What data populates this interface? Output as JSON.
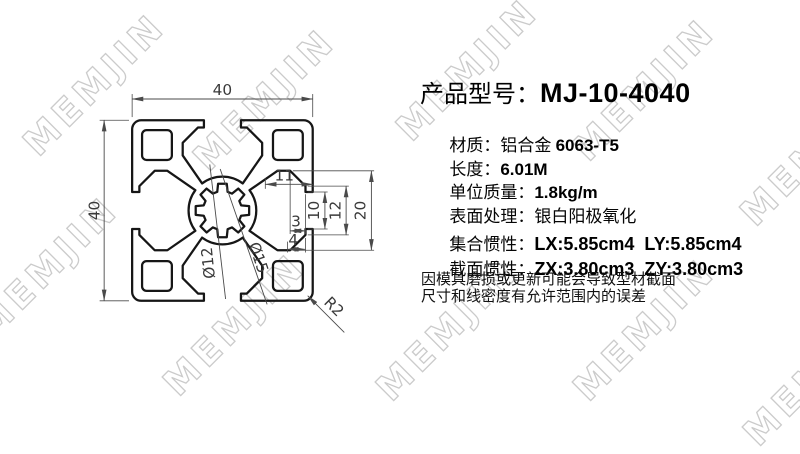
{
  "watermark": {
    "text": "MEMJIN",
    "stroke_color": "#cbcbcb"
  },
  "drawing": {
    "dims": {
      "overall_width": "40",
      "overall_height": "40",
      "slot_depth": "11",
      "opening_10": "10",
      "opening_12": "12",
      "cavity_height": "20",
      "lip_3": "3",
      "lip_4": "4",
      "bore_dia": "Ø12",
      "hub_dia": "Ø15",
      "corner_radius": "R2"
    }
  },
  "panel": {
    "title": {
      "label": "产品型号：",
      "model": "MJ-10-4040"
    },
    "specs": [
      {
        "label": "材质：",
        "pre": "铝合金 ",
        "value": "6063-T5"
      },
      {
        "label": "长度：",
        "pre": "",
        "value": "6.01M"
      },
      {
        "label": "单位质量：",
        "pre": "",
        "value": "1.8kg/m"
      },
      {
        "label": "表面处理：",
        "pre": "银白阳极氧化",
        "value": ""
      }
    ],
    "inertia": [
      {
        "label": "集合惯性：",
        "value": "LX:5.85cm4  LY:5.85cm4"
      },
      {
        "label": "截面惯性：",
        "value": "ZX:3.80cm3  ZY:3.80cm3"
      }
    ],
    "notes": [
      "因模具磨损或更新可能会导致型材截面",
      "尺寸和线密度有允许范围内的误差"
    ]
  }
}
